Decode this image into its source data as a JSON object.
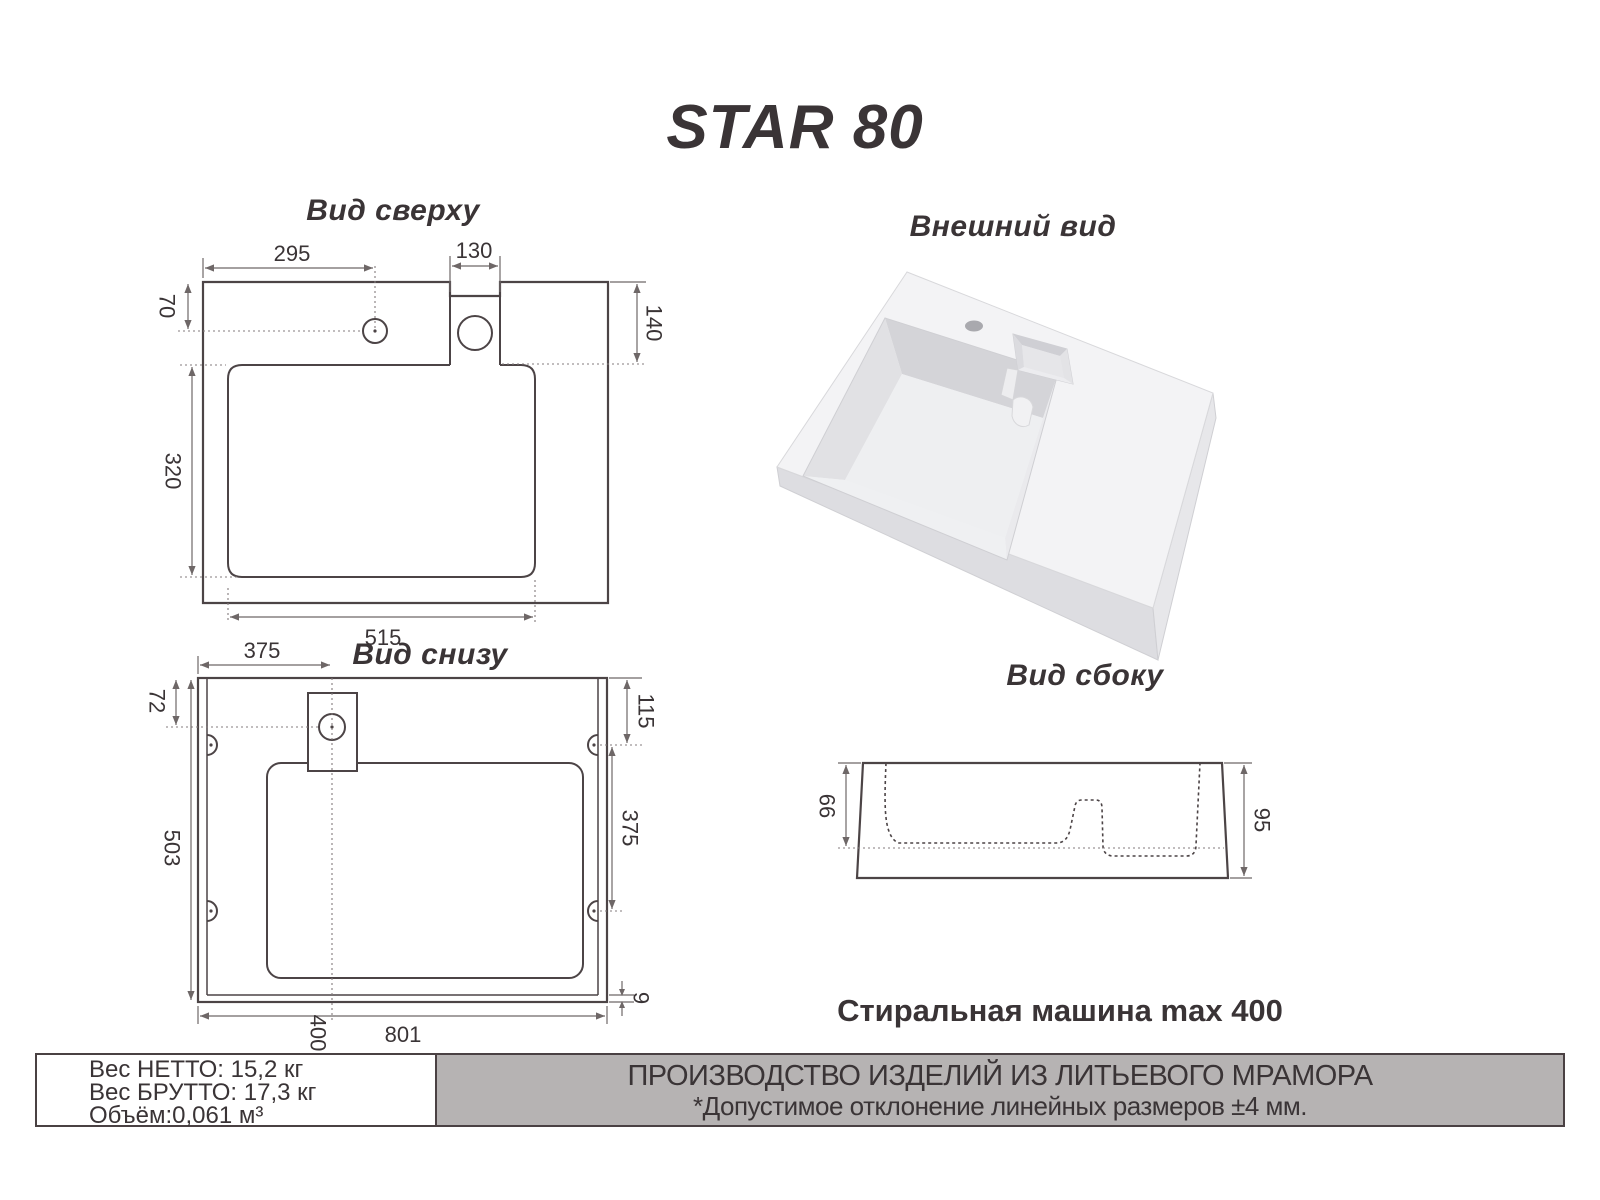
{
  "title": "STAR 80",
  "views": {
    "top": {
      "label": "Вид сверху",
      "dims": {
        "hole_x": "295",
        "tab_w": "130",
        "hole_y": "70",
        "tab_d": "140",
        "basin_h": "320",
        "basin_w": "515"
      }
    },
    "bottom": {
      "label": "Вид снизу",
      "dims": {
        "tap_x": "375",
        "tap_y": "72",
        "hole1_y": "115",
        "holes_gap": "375",
        "height": "503",
        "center_x": "400",
        "width": "801",
        "edge": "9"
      }
    },
    "external": {
      "label": "Внешний вид"
    },
    "side": {
      "label": "Вид сбоку",
      "dims": {
        "basin_depth": "66",
        "height": "95"
      }
    }
  },
  "note": "Стиральная машина max 400",
  "info": {
    "net": "Вес НЕТТО: 15,2 кг",
    "gross": "Вес БРУТТО: 17,3 кг",
    "volume": "Объём:0,061 м³"
  },
  "banner": {
    "line1": "ПРОИЗВОДСТВО ИЗДЕЛИЙ ИЗ ЛИТЬЕВОГО МРАМОРА",
    "line2": "*Допустимое отклонение линейных размеров ±4 мм."
  },
  "colors": {
    "object_line": "#4c4446",
    "dim_line": "#6e6767",
    "text": "#3a3436",
    "banner_bg": "#b6b3b3",
    "border": "#4a4143",
    "render_light": "#f3f3f5",
    "render_mid": "#e1e1e4",
    "render_dark": "#d4d4d8"
  }
}
